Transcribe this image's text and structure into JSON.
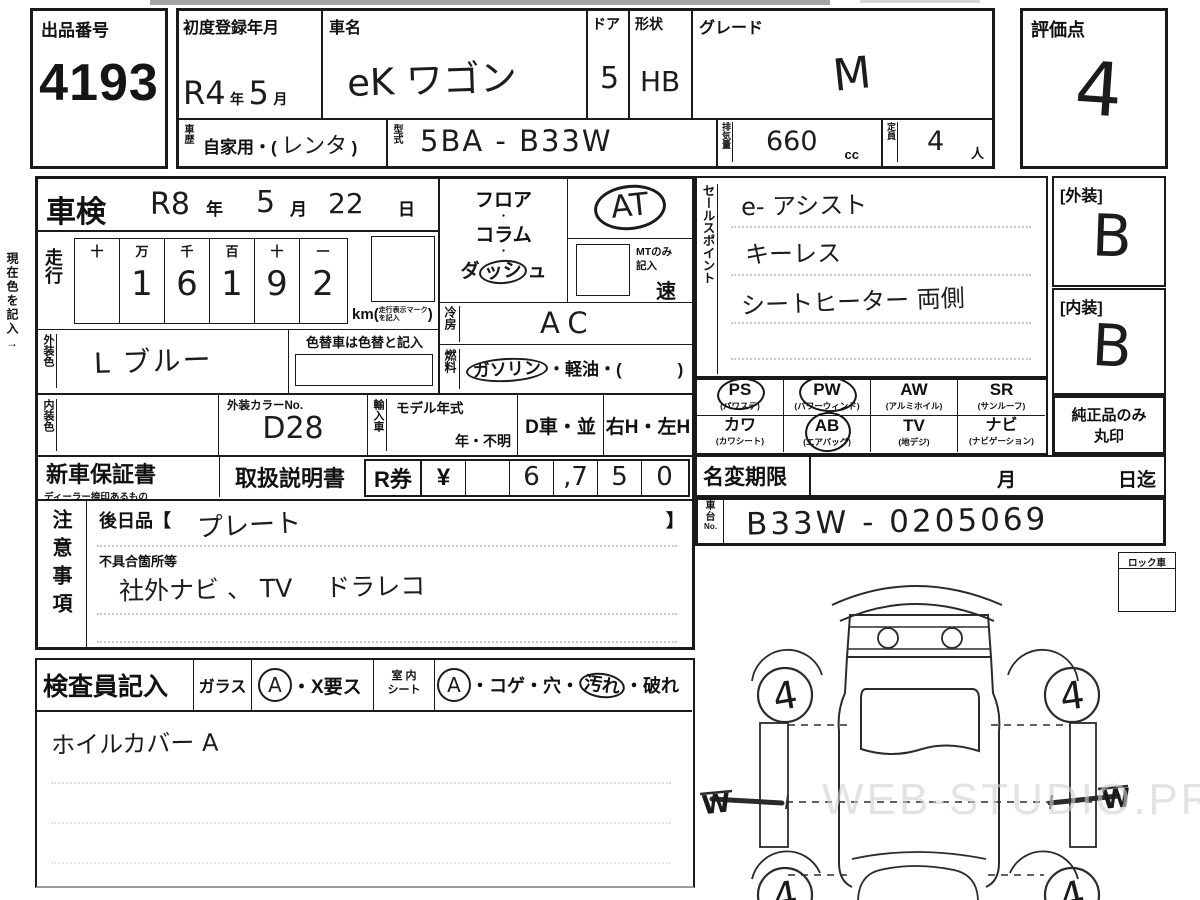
{
  "sheet": {
    "lot": {
      "label": "出品番号",
      "number": "4193"
    },
    "first_reg": {
      "label": "初度登録年月",
      "era": "R4",
      "year_suffix": "年",
      "month": "5",
      "month_suffix": "月"
    },
    "car_name": {
      "label": "車名",
      "value": "eK ワゴン"
    },
    "doors": {
      "label": "ドア",
      "value": "5"
    },
    "shape": {
      "label": "形状",
      "value": "HB"
    },
    "grade": {
      "label": "グレード",
      "value": "M"
    },
    "history": {
      "label": "車歴",
      "printed": "自家用・(",
      "hand": "レンタ",
      "close": ")"
    },
    "model_code": {
      "label": "型式",
      "value": "5BA - B33W"
    },
    "displacement": {
      "label": "排気量",
      "value": "660",
      "unit": "cc"
    },
    "capacity": {
      "label": "定員",
      "value": "4",
      "unit": "人"
    },
    "score": {
      "label": "評価点",
      "value": "4"
    }
  },
  "inspection": {
    "label": "車検",
    "year": "R8",
    "year_suffix": "年",
    "month": "5",
    "month_suffix": "月",
    "day": "22",
    "day_suffix": "日"
  },
  "mileage": {
    "label": "走行",
    "headers": [
      "十",
      "万",
      "千",
      "百",
      "十",
      "一"
    ],
    "digits": [
      "",
      "1",
      "6",
      "1",
      "9",
      "2"
    ],
    "unit": "km",
    "unit_note1": "走行表示マーク",
    "unit_note2": "を記入"
  },
  "shift": {
    "floor": "フロア",
    "dot1": "・",
    "column": "コラム",
    "dot2": "・",
    "dash_pre": "ダ",
    "dash_circled": "ッシ",
    "dash_post": "ュ",
    "value": "AT",
    "mt_note1": "MTのみ",
    "mt_note2": "記入",
    "speed": "速"
  },
  "cooling": {
    "label": "冷房",
    "value": "AC"
  },
  "fuel": {
    "label": "燃料",
    "circled": "ガソリン",
    "rest": "・軽油・(",
    "close": ")"
  },
  "exterior_color": {
    "label": "外装色",
    "value": "L ブルー",
    "note": "色替車は色替と記入"
  },
  "interior_color": {
    "label": "内装色",
    "color_no_label": "外装カラーNo.",
    "color_no": "D28"
  },
  "import_row": {
    "import_label": "輸入車",
    "model_year_label": "モデル年式",
    "model_year_value": "年・不明",
    "dealer": "D車・並",
    "handle": "右H・左H"
  },
  "sales_points": {
    "label": "セールスポイント",
    "lines": [
      "e- アシスト",
      "キーレス",
      "シートヒーター 両側"
    ]
  },
  "equipment": {
    "cells": [
      {
        "code": "PS",
        "name": "(パワステ)",
        "circled": true
      },
      {
        "code": "PW",
        "name": "(パワーウィンド)",
        "circled": true
      },
      {
        "code": "AW",
        "name": "(アルミホイル)",
        "circled": false
      },
      {
        "code": "SR",
        "name": "(サンルーフ)",
        "circled": false
      },
      {
        "code": "カワ",
        "name": "(カワシート)",
        "circled": false
      },
      {
        "code": "AB",
        "name": "(エアバッグ)",
        "circled": true
      },
      {
        "code": "TV",
        "name": "(地デジ)",
        "circled": false
      },
      {
        "code": "ナビ",
        "name": "(ナビゲーション)",
        "circled": false
      }
    ]
  },
  "grades": {
    "exterior_label": "[外装]",
    "exterior": "B",
    "interior_label": "[内装]",
    "interior": "B",
    "genuine_line1": "純正品のみ",
    "genuine_line2": "丸印"
  },
  "warranty": {
    "label": "新車保証書",
    "sub": "ディーラー捺印あるもの",
    "manual": "取扱説明書",
    "ticket": "R券",
    "currency": "¥",
    "digits": [
      "",
      "6",
      ",7",
      "5",
      "0"
    ],
    "amount": "6,750"
  },
  "name_change": {
    "label": "名変期限",
    "month_suffix": "月",
    "day_suffix": "日迄"
  },
  "chassis": {
    "label1": "車",
    "label2": "台",
    "label3": "No.",
    "value": "B33W - 0205069"
  },
  "cautions": {
    "label": "注意事項",
    "later_open": "後日品【",
    "later_value": "プレート",
    "later_close": "】",
    "defect_label": "不具合箇所等",
    "defect_value": "社外ナビ 、 TV　 ドラレコ"
  },
  "inspector": {
    "label": "検査員記入",
    "glass_label": "ガラス",
    "glass_a": "A",
    "glass_rest": "・X要ス",
    "seat_label1": "室 内",
    "seat_label2": "シート",
    "seat_a": "A",
    "seat_pre": "・コゲ・穴・",
    "seat_circled": "汚れ",
    "seat_post": "・破れ",
    "note": "ホイルカバー A"
  },
  "lock": {
    "label": "ロック車"
  },
  "margin_note": "現在色を記入→",
  "diagram": {
    "tire_fl": "4",
    "tire_fr": "4",
    "tire_rl": "4",
    "tire_rr": "4",
    "mark_left": "W",
    "mark_right": "W"
  },
  "watermark": "WEB-STUDIO.PRO"
}
